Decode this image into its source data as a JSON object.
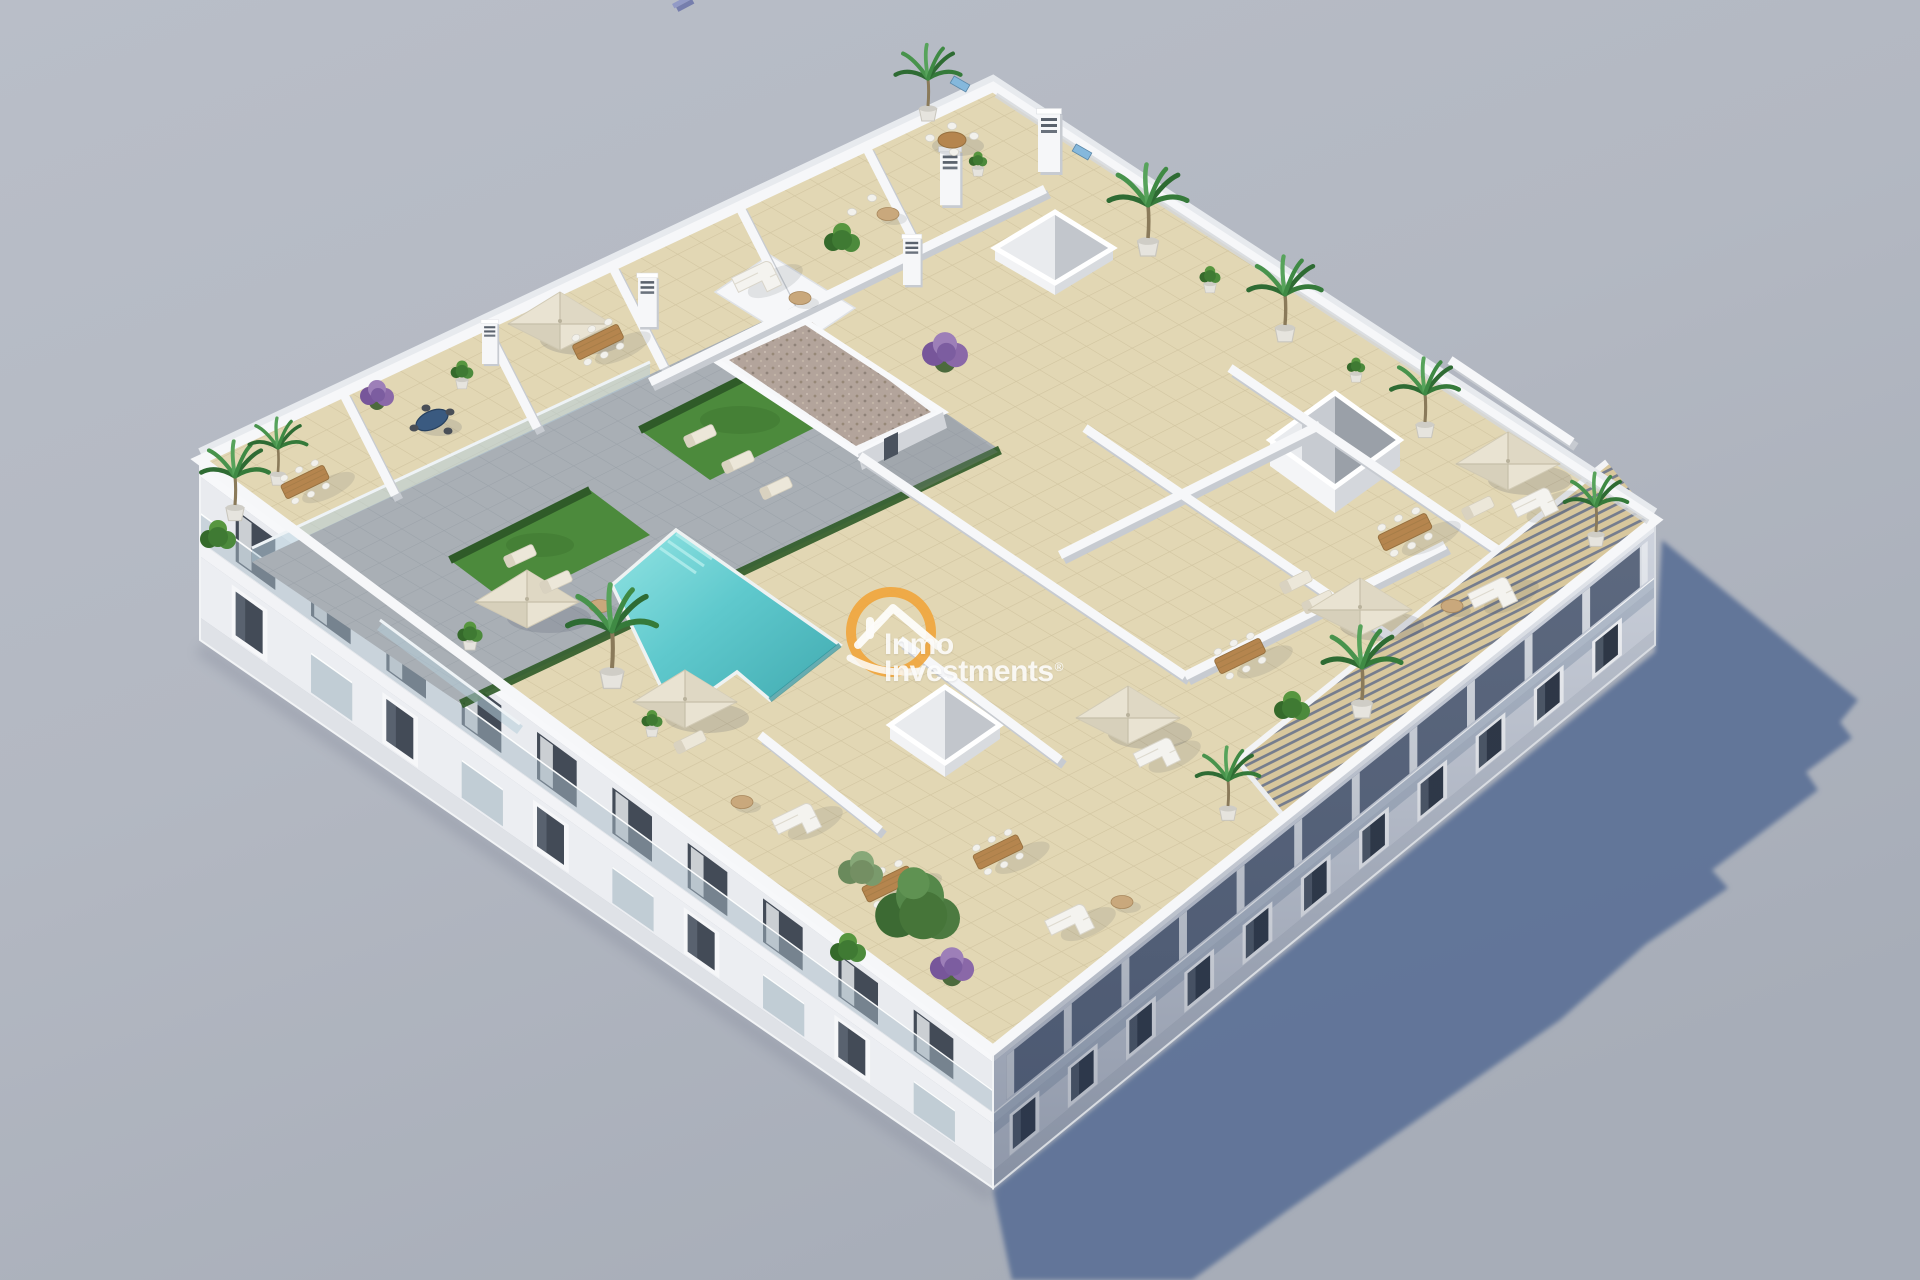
{
  "image": {
    "kind": "3d-architectural-aerial-render",
    "description": "Aerial 3D render of a white apartment block with rooftop terraces, communal pool courtyard, parasols, plants and a long cast shadow on grey ground",
    "width": 1920,
    "height": 1280
  },
  "watermark": {
    "line1": "Inmo",
    "line2": "Investments",
    "registered": "®",
    "logo_icon": "house-in-ring",
    "logo_color": "#f0a63c",
    "text_color": "#ffffff"
  },
  "palette": {
    "bg_top": "#b9bec8",
    "bg_mid": "#b3b8c2",
    "bg_bottom": "#a7adb8",
    "shadow": "#5e7297",
    "tile": "#e2d7b4",
    "tile_grout": "#bdb08a",
    "deck": "#a9afb5",
    "deck_grout": "#878e95",
    "pool_water": "#5fc9cd",
    "pool_light": "#93e4e3",
    "pool_deep": "#3fa8ae",
    "grass": "#4c8a3c",
    "hedge": "#2f5b28",
    "parasol": "#e9e3d2",
    "wood": "#b5854e",
    "sofa": "#f3f2ed",
    "gravel": "#b3a49b",
    "louver": "#d8c79d",
    "wall_white": "#f6f7f9",
    "wall_shade": "#c7cbd1",
    "facade_left": "#e9ebef",
    "facade_right": "#cfd4de",
    "window_dark": "#3c4450",
    "glass_rail": "#a9bcc8",
    "logo_orange": "#f0a63c"
  }
}
